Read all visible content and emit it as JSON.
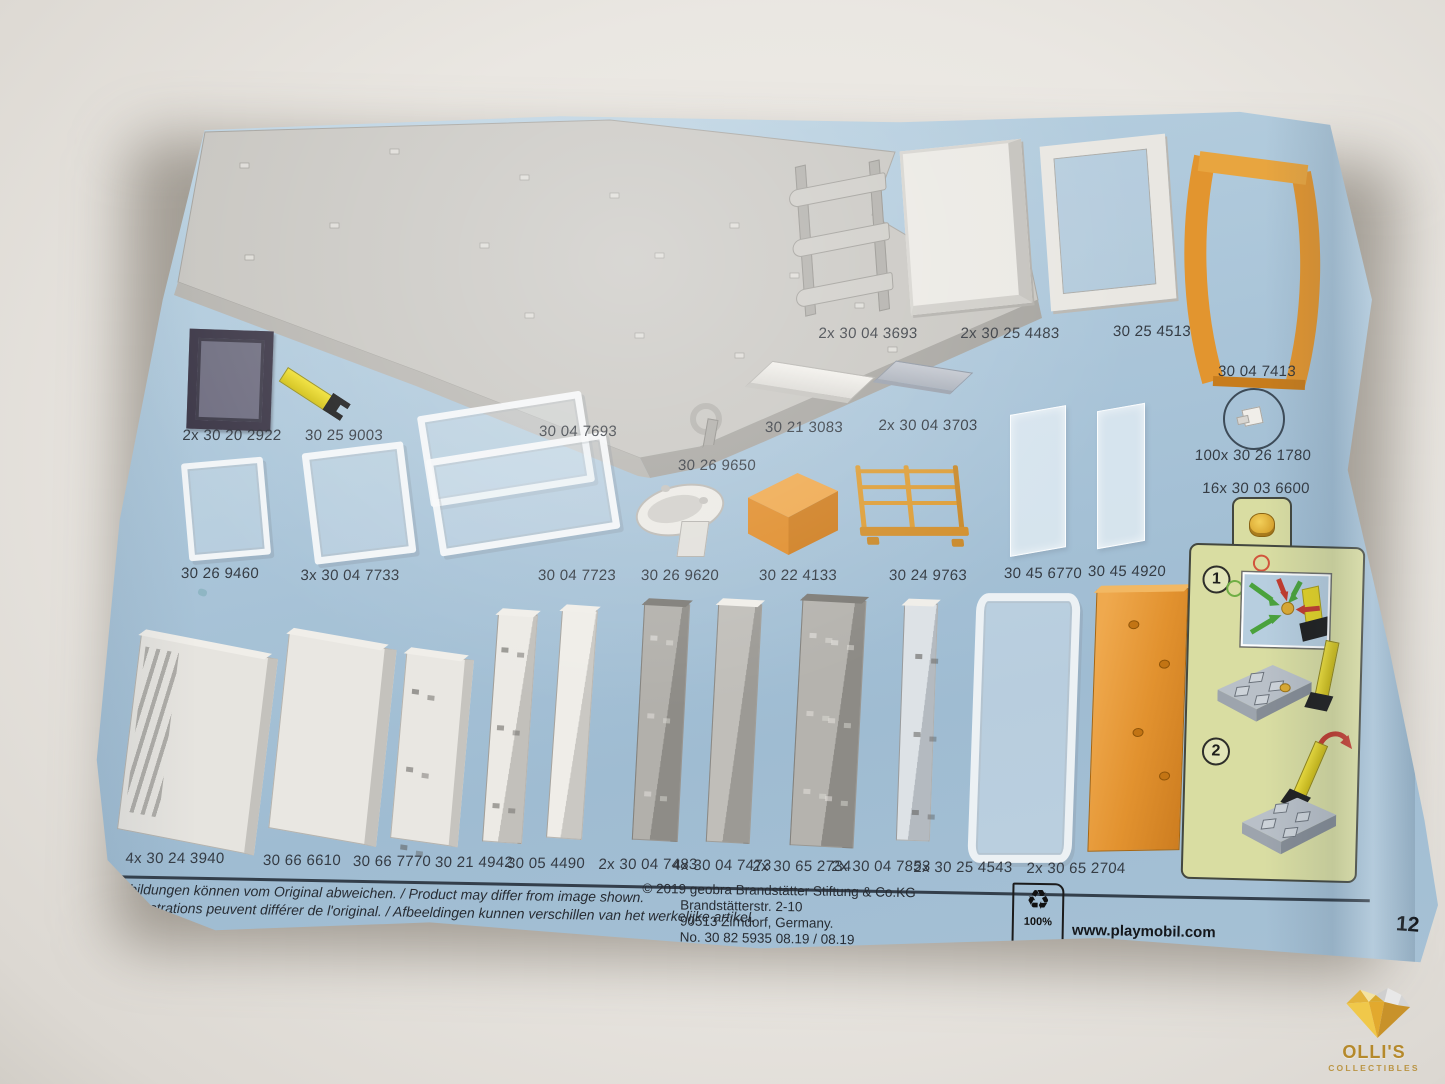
{
  "paper": {
    "page_number": "12"
  },
  "parts": [
    {
      "label": "2x 30 04 3693"
    },
    {
      "label": "2x 30 25 4483"
    },
    {
      "label": "30 25 4513"
    },
    {
      "label": "30 04 7413"
    },
    {
      "label": "2x 30 20 2922"
    },
    {
      "label": "30 25 9003"
    },
    {
      "label": "30 04 7693"
    },
    {
      "label": "30 26 9650"
    },
    {
      "label": "30 21 3083"
    },
    {
      "label": "2x 30 04 3703"
    },
    {
      "label": "100x 30 26 1780"
    },
    {
      "label": "30 26 9460"
    },
    {
      "label": "3x 30 04 7733"
    },
    {
      "label": "30 04 7723"
    },
    {
      "label": "30 26 9620"
    },
    {
      "label": "30 22 4133"
    },
    {
      "label": "30 24 9763"
    },
    {
      "label": "30 45 6770"
    },
    {
      "label": "30 45 4920"
    },
    {
      "label": "4x 30 24 3940"
    },
    {
      "label": "30 66 6610"
    },
    {
      "label": "30 66 7770"
    },
    {
      "label": "30 21 4942"
    },
    {
      "label": "30 05 4490"
    },
    {
      "label": "2x 30 04 7483"
    },
    {
      "label": "4x 30 04 7473"
    },
    {
      "label": "2x 30 65 2734"
    },
    {
      "label": "2x 30 04 7853"
    },
    {
      "label": "2x 30 25 4543"
    },
    {
      "label": "2x 30 65 2704"
    }
  ],
  "assembly": {
    "count_label": "16x 30 03 6600",
    "step1_number": "1",
    "step2_number": "2"
  },
  "footer": {
    "disclaimer_de_en": "Abbildungen können vom Original abweichen. / Product may differ from image shown.",
    "disclaimer_fr_nl": "Les illustrations peuvent différer de l'original. / Afbeeldingen kunnen verschillen van het werkelijke artikel.",
    "copyright_line1": "© 2019 geobra Brandstätter Stiftung & Co.KG",
    "copyright_line2": "Brandstätterstr. 2-10",
    "copyright_line3": "90513 Zirndorf, Germany.",
    "copyright_line4": "No. 30 82 5935     08.19  /  08.19",
    "recycle_glyph": "♻",
    "recycle_percent": "100%",
    "website": "www.playmobil.com"
  },
  "watermark": {
    "title": "OLLI'S",
    "subtitle": "COLLECTIBLES"
  },
  "colors": {
    "paper_blue": "#a9c4d8",
    "part_orange": "#e0932f",
    "tool_yellow": "#e6d426",
    "assembly_green": "#d9dda2",
    "gray_part": "#c8c6c1"
  }
}
